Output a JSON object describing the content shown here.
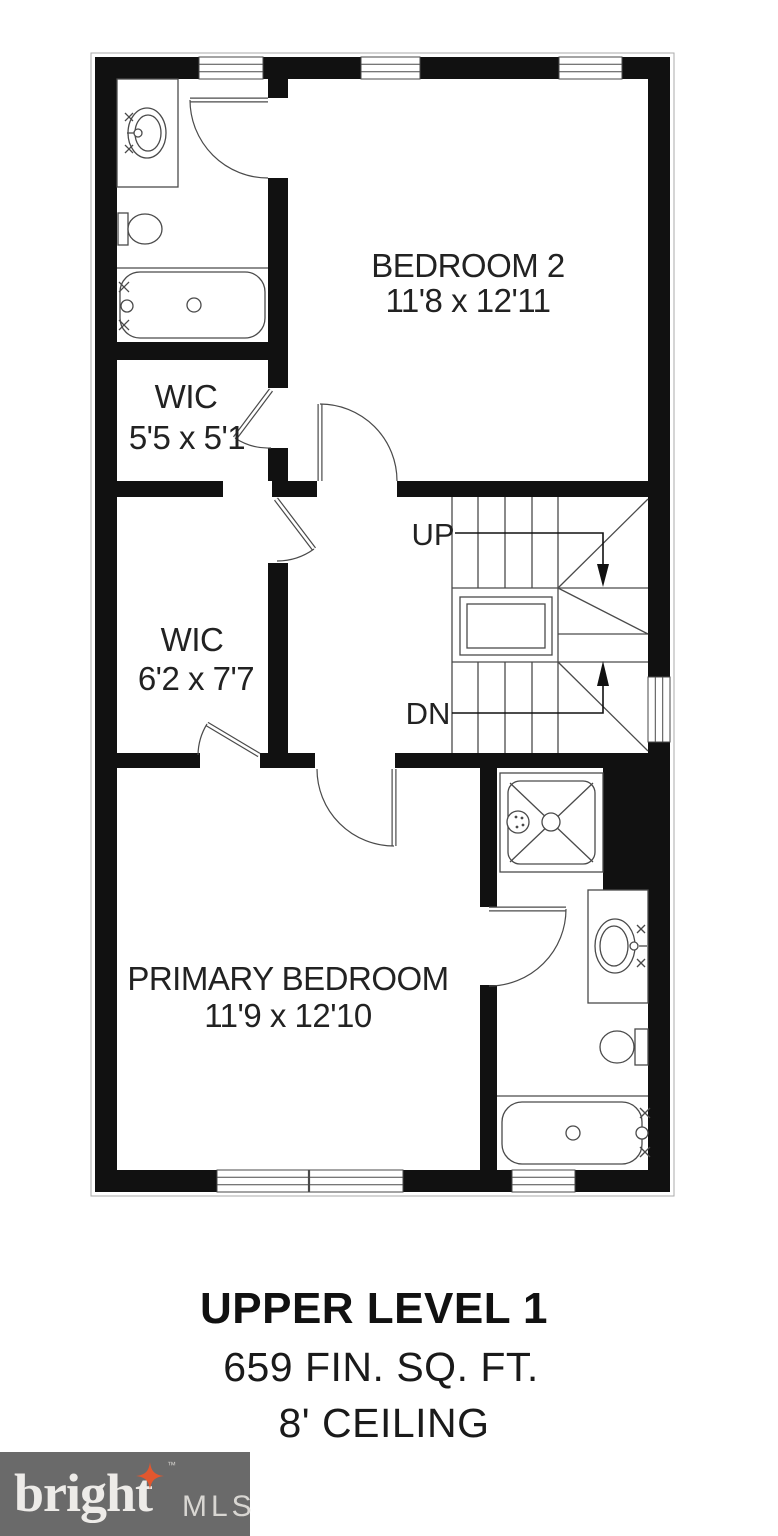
{
  "plan": {
    "rooms": [
      {
        "name": "BEDROOM 2",
        "dims": "11'8 x 12'11"
      },
      {
        "name": "WIC",
        "dims": "5'5 x 5'1"
      },
      {
        "name": "WIC",
        "dims": "6'2 x 7'7"
      },
      {
        "name": "PRIMARY BEDROOM",
        "dims": "11'9 x 12'10"
      }
    ],
    "stair_up_label": "UP",
    "stair_down_label": "DN"
  },
  "title_block": {
    "level_name": "UPPER LEVEL 1",
    "finished_area": "659 FIN. SQ. FT.",
    "ceiling_height": "8' CEILING"
  },
  "branding": {
    "name": "bright",
    "suffix": "MLS",
    "tm": "™"
  },
  "colors": {
    "wall": "#111111",
    "line": "#4a4a4a",
    "fixture_fill": "#c9e0f1",
    "logo_bg": "#6a6a6a",
    "logo_text": "#edebe8",
    "logo_star": "#e2572e",
    "text": "#1c1c1c"
  }
}
